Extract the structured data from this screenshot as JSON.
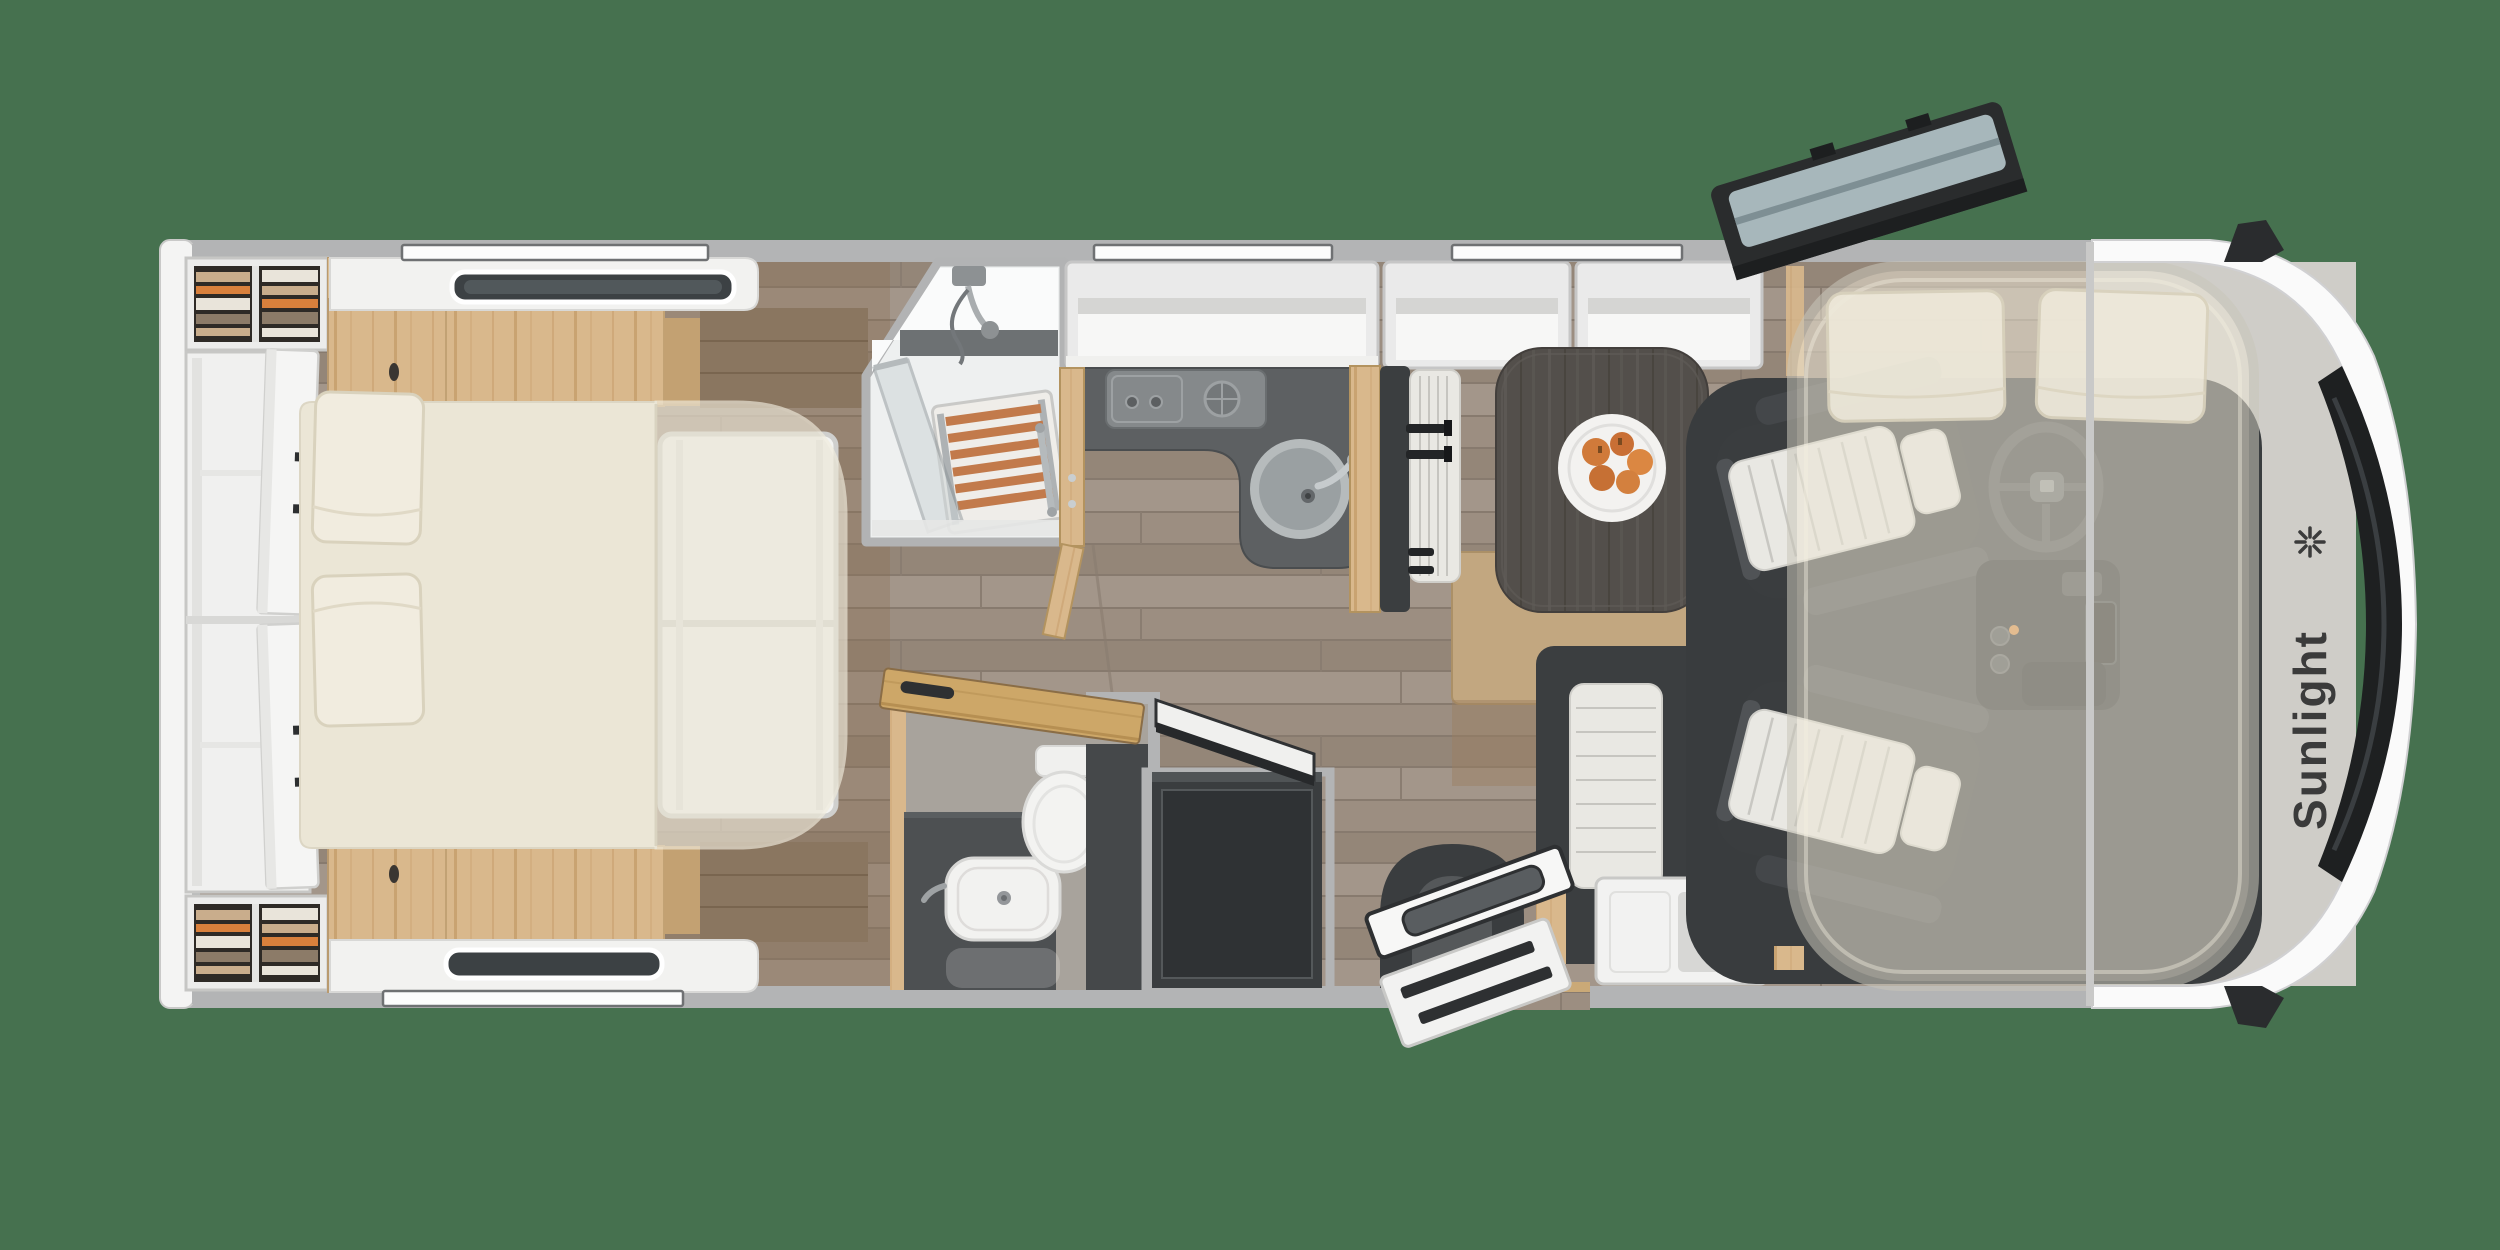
{
  "brand": {
    "name": "Sunlight",
    "logo_icon": "sunlight-asterisk-icon"
  },
  "scene": {
    "type": "motorhome-floor-plan-top-view",
    "background_color": "#46714F",
    "vehicle_orientation": "front-right"
  },
  "palette": {
    "background_green": "#46714F",
    "wall_gray": "#b3b4b5",
    "body_white": "#fafafa",
    "floor_wood": "#9c8e81",
    "oak_wood": "#d9b88c",
    "walnut_wood": "#8a7660",
    "dark_furniture": "#3b3e40",
    "counter_gray": "#5d6062",
    "mattress_cream": "#ebe6d6",
    "upholstery_stripe": "#e9e8e3",
    "teak_slats": "#c27a4b",
    "accent_orange": "#d9803c",
    "windshield_black": "#1e2021",
    "hatch_glass": "#a7b7bb",
    "logo_color": "#3b3b3b"
  },
  "zones": [
    "rear-bedroom-with-double-bed",
    "wardrobes-with-clothes",
    "roof-skylights",
    "shower-room-with-teak-grate",
    "kitchen-with-stove-and-sink",
    "bathroom-with-basin-and-toilet",
    "fridge-with-open-lid",
    "dinette-with-table-and-fruit-plate",
    "belted-travel-bench",
    "entry-door-with-steps",
    "swivel-cab-seats",
    "steering-wheel-and-dashboard",
    "overcab-drop-down-bed",
    "front-cap-with-windshield",
    "side-mirrors",
    "open-roof-hatch"
  ]
}
